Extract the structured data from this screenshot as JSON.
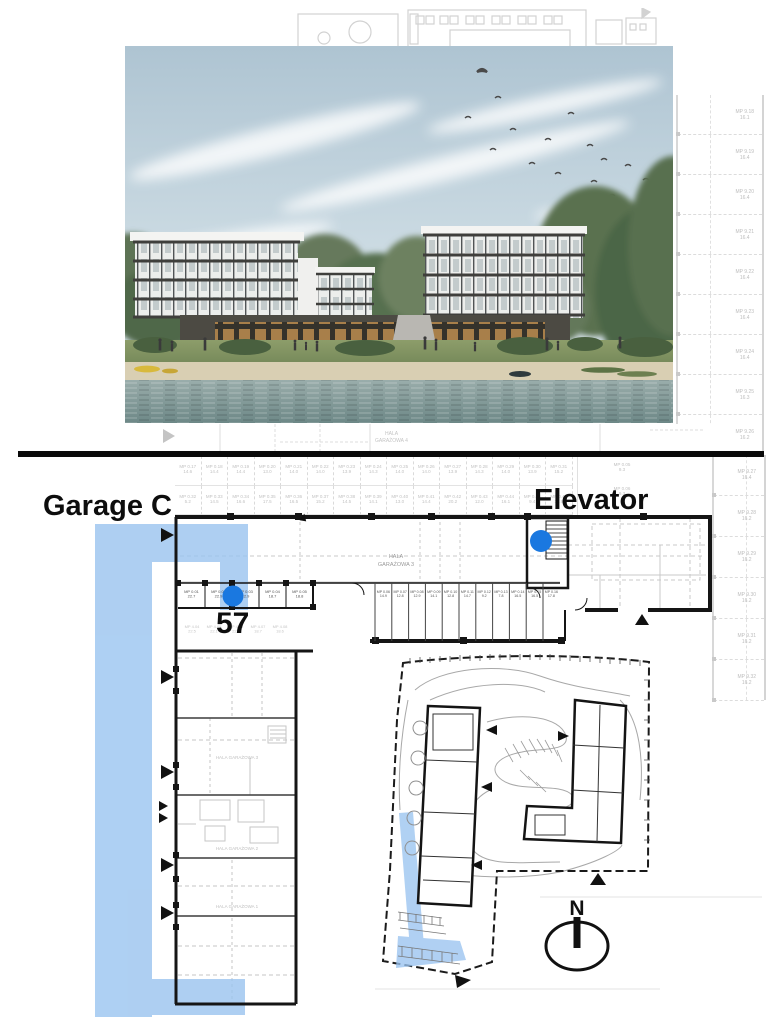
{
  "labels": {
    "garage": "Garage C",
    "elevator": "Elevator",
    "space_number": "57",
    "compass_north": "N"
  },
  "colors": {
    "highlight_blue": "#9ac4f0",
    "marker_blue": "#1a78e0",
    "plan_dark": "#151515",
    "plan_faint": "#c9c9c9",
    "separator_black": "#0a0a0a"
  },
  "photo": {
    "alt": "Architectural rendering of two modern apartment buildings on a lakefront with beach, lawn, trees and birds in the sky"
  },
  "floor_plan": {
    "hall_upper": [
      "HALA",
      "GARAŻOWA 4"
    ],
    "corridor": [
      "HALA",
      "GARAŻOWA 3"
    ],
    "wing_halls": [
      "HALA GARAŻOWA 3",
      "HALA GARAŻOWA 2",
      "HALA GARAŻOWA 1"
    ],
    "main_row_spaces": [
      {
        "id": "MP 0.01",
        "area": "22.7"
      },
      {
        "id": "MP 0.02",
        "area": "22.9"
      },
      {
        "id": "MP 0.03",
        "area": "22.9"
      },
      {
        "id": "MP 0.04",
        "area": "18.7"
      },
      {
        "id": "MP 0.05",
        "area": "18.8"
      }
    ],
    "store_rooms": [
      {
        "id": "MP 0.06",
        "area": "14.9"
      },
      {
        "id": "MP 0.07",
        "area": "12.8"
      },
      {
        "id": "MP 0.08",
        "area": "12.9"
      },
      {
        "id": "MP 0.09",
        "area": "14.1"
      },
      {
        "id": "MP 0.10",
        "area": "12.8"
      },
      {
        "id": "MP 0.11",
        "area": "14.7"
      },
      {
        "id": "MP 0.12",
        "area": "9.2"
      },
      {
        "id": "MP 0.13",
        "area": "7.8"
      },
      {
        "id": "MP 0.14",
        "area": "16.5"
      },
      {
        "id": "MP 0.15",
        "area": "16.5"
      },
      {
        "id": "MP 0.16",
        "area": "17.8"
      }
    ],
    "wing_row_spaces": [
      {
        "id": "MP 4.04",
        "area": "22.5"
      },
      {
        "id": "MP 4.05",
        "area": "22.1"
      },
      {
        "id": "MP 4.06",
        "area": "22.1"
      },
      {
        "id": "MP 4.07",
        "area": "18.7"
      },
      {
        "id": "MP 4.08",
        "area": "18.6"
      }
    ],
    "upper_row_1": [
      {
        "id": "MP 0.17",
        "area": "14.6"
      },
      {
        "id": "MP 0.18",
        "area": "14.4"
      },
      {
        "id": "MP 0.19",
        "area": "14.4"
      },
      {
        "id": "MP 0.20",
        "area": "13.0"
      },
      {
        "id": "MP 0.21",
        "area": "14.0"
      },
      {
        "id": "MP 0.22",
        "area": "14.0"
      },
      {
        "id": "MP 0.23",
        "area": "13.9"
      },
      {
        "id": "MP 0.24",
        "area": "14.3"
      },
      {
        "id": "MP 0.25",
        "area": "14.0"
      },
      {
        "id": "MP 0.26",
        "area": "14.0"
      },
      {
        "id": "MP 0.27",
        "area": "13.9"
      },
      {
        "id": "MP 0.28",
        "area": "14.3"
      },
      {
        "id": "MP 0.29",
        "area": "14.0"
      },
      {
        "id": "MP 0.30",
        "area": "13.9"
      },
      {
        "id": "MP 0.31",
        "area": "15.2"
      }
    ],
    "upper_row_2": [
      {
        "id": "MP 0.32",
        "area": "5.2"
      },
      {
        "id": "MP 0.33",
        "area": "14.5"
      },
      {
        "id": "MP 0.34",
        "area": "16.6"
      },
      {
        "id": "MP 0.35",
        "area": "17.5"
      },
      {
        "id": "MP 0.36",
        "area": "16.5"
      },
      {
        "id": "MP 0.37",
        "area": "15.2"
      },
      {
        "id": "MP 0.38",
        "area": "14.5"
      },
      {
        "id": "MP 0.39",
        "area": "14.1"
      },
      {
        "id": "MP 0.40",
        "area": "13.0"
      },
      {
        "id": "MP 0.41",
        "area": "14.4"
      },
      {
        "id": "MP 0.42",
        "area": "20.2"
      },
      {
        "id": "MP 0.43",
        "area": "12.0"
      },
      {
        "id": "MP 0.44",
        "area": "16.1"
      },
      {
        "id": "MP 0.45",
        "area": "9.4"
      },
      {
        "id": "MP 0.46",
        "area": "17.9"
      }
    ],
    "side_rooms": [
      {
        "id": "MP 0.05",
        "area": "9.3"
      },
      {
        "id": "MP 0.06",
        "area": "9.3"
      }
    ],
    "right_column_spaces": [
      {
        "id": "MP 9.18",
        "area": "16.1"
      },
      {
        "id": "MP 9.19",
        "area": "16.4"
      },
      {
        "id": "MP 9.20",
        "area": "16.4"
      },
      {
        "id": "MP 9.21",
        "area": "16.4"
      },
      {
        "id": "MP 9.22",
        "area": "16.4"
      },
      {
        "id": "MP 9.23",
        "area": "16.4"
      },
      {
        "id": "MP 9.24",
        "area": "16.4"
      },
      {
        "id": "MP 9.25",
        "area": "16.3"
      },
      {
        "id": "MP 9.26",
        "area": "16.2"
      },
      {
        "id": "MP 9.27",
        "area": "16.4"
      },
      {
        "id": "MP 9.28",
        "area": "16.2"
      },
      {
        "id": "MP 9.29",
        "area": "16.2"
      },
      {
        "id": "MP 9.30",
        "area": "16.2"
      },
      {
        "id": "MP 9.31",
        "area": "16.2"
      },
      {
        "id": "MP 9.32",
        "area": "16.2"
      }
    ]
  }
}
